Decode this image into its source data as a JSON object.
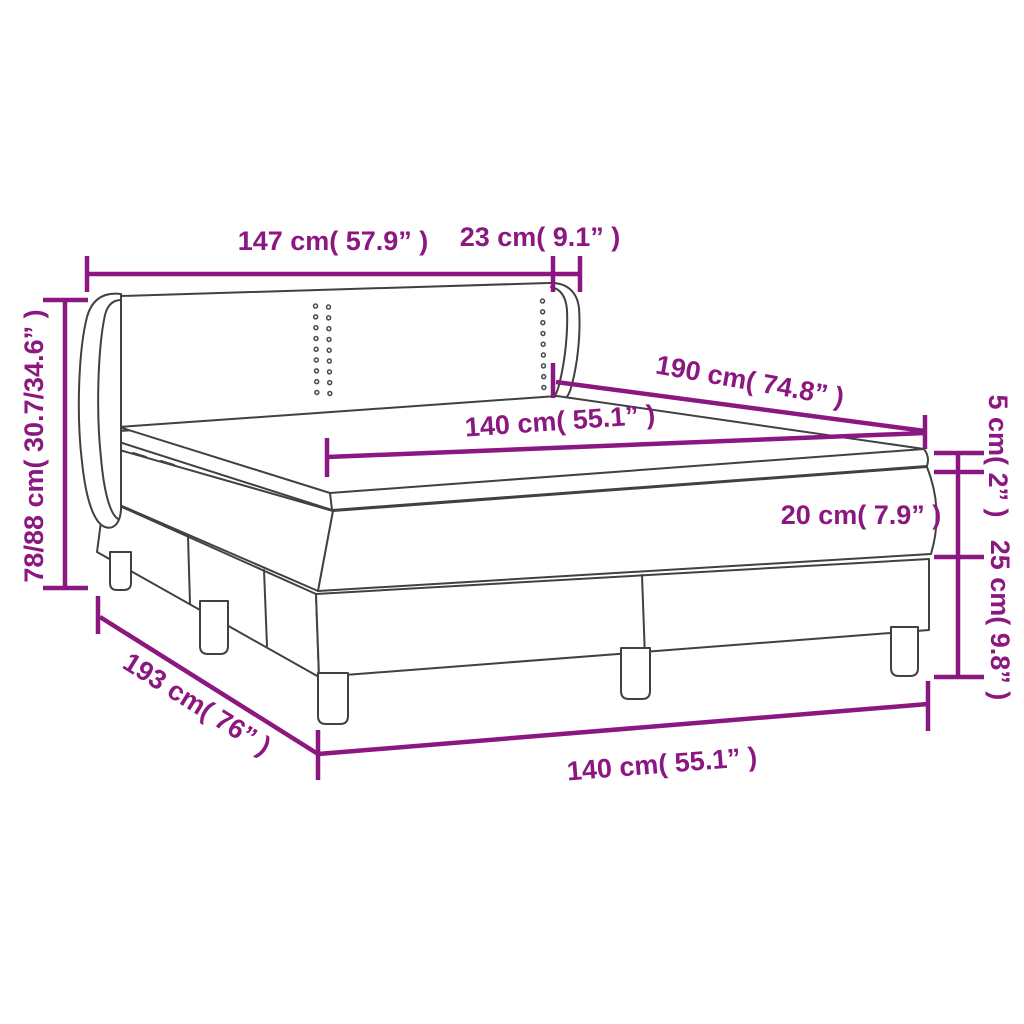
{
  "diagram": {
    "type": "product-dimension-diagram",
    "subject": "box spring bed with headboard, mattress and topper",
    "accent_color": "#8b1780",
    "line_color": "#414141",
    "background_color": "#ffffff",
    "labels": {
      "headboard_width": "147 cm( 57.9” )",
      "headboard_wing_depth": "23 cm( 9.1” )",
      "total_height": "78/88 cm( 30.7/34.6” )",
      "bed_length": "190 cm( 74.8” )",
      "mattress_width": "140 cm( 55.1” )",
      "topper_height": "5 cm( 2” )",
      "mattress_height": "20 cm( 7.9” )",
      "base_height": "25 cm( 9.8” )",
      "base_length": "193 cm( 76” )",
      "base_width": "140 cm( 55.1” )"
    }
  }
}
